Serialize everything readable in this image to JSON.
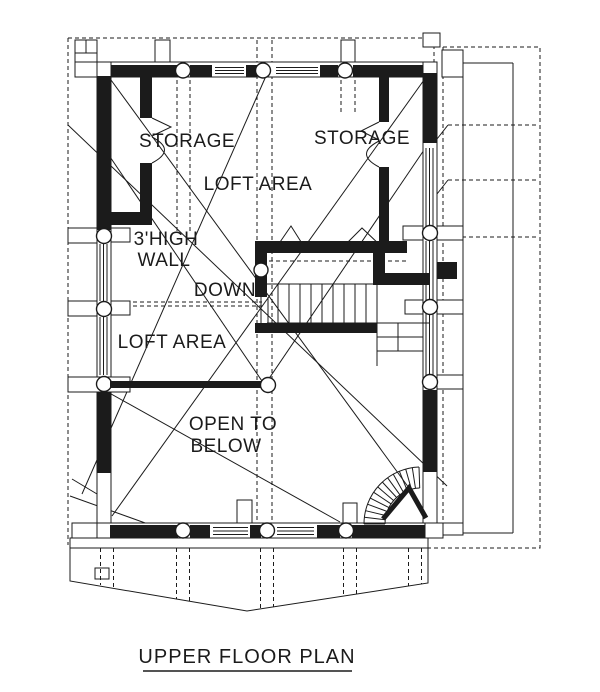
{
  "drawing": {
    "title": "UPPER FLOOR PLAN",
    "labels": {
      "storage_left": "STORAGE",
      "storage_right": "STORAGE",
      "loft_area_upper": "LOFT AREA",
      "high_wall_line1": "3'HIGH",
      "high_wall_line2": "WALL",
      "down": "DOWN",
      "loft_area_lower": "LOFT AREA",
      "open_to_below_line1": "OPEN TO",
      "open_to_below_line2": "BELOW"
    },
    "colors": {
      "ink": "#1b1b1b",
      "paper": "#ffffff"
    }
  }
}
